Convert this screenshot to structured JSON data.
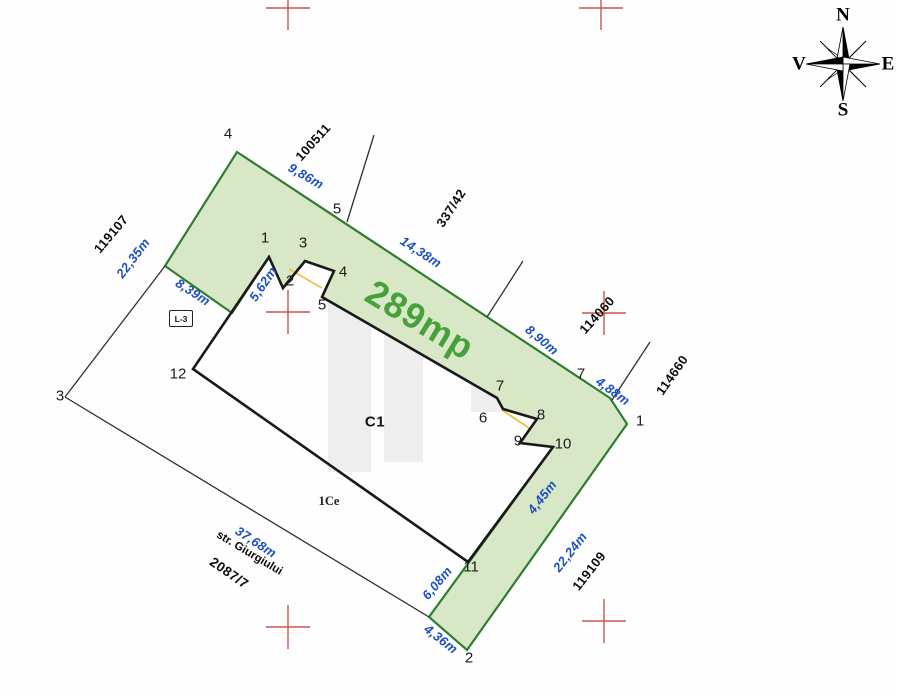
{
  "plan": {
    "area_label": "289mp",
    "street_name": "str. Giurgiului"
  },
  "compass": {
    "north": "N",
    "south": "S",
    "east": "E",
    "west": "V"
  },
  "measurements": {
    "m9_86": "9,86m",
    "m22_35": "22,35m",
    "m8_39": "8,39m",
    "m5_62": "5,62m",
    "m14_38": "14,38m",
    "m8_90": "8,90m",
    "m4_88": "4,88m",
    "m4_45": "4,45m",
    "m22_24": "22,24m",
    "m6_08": "6,08m",
    "m4_36": "4,36m",
    "m37_68": "37,68m"
  },
  "neighbor_parcels": {
    "n100511": "100511",
    "n119107": "119107",
    "n337_42": "337/42",
    "n114060": "114060",
    "n114660": "114660",
    "n119109": "119109",
    "n2087_7": "2087/7"
  },
  "buildings": {
    "c1": "C1",
    "ce": "1Ce",
    "l3": "L-3"
  },
  "parcel_points": {
    "p1": "1",
    "p2": "2",
    "p3": "3",
    "p4": "4",
    "p5": "5",
    "p7": "7"
  },
  "building_points": {
    "b1": "1",
    "b2": "2",
    "b3": "3",
    "b4": "4",
    "b5": "5",
    "b6": "6",
    "b7": "7",
    "b8": "8",
    "b9": "9",
    "b10": "10",
    "b11": "11",
    "b12": "12"
  },
  "colors": {
    "parcel_fill": "#d8e8c6",
    "parcel_stroke": "#2f7d31",
    "building_stroke": "#191919",
    "measure_blue": "#1d4fc4",
    "area_green": "#46a03c",
    "grid_cross_red": "#c9564a",
    "shared_wall_yellow": "#e8c64b"
  }
}
